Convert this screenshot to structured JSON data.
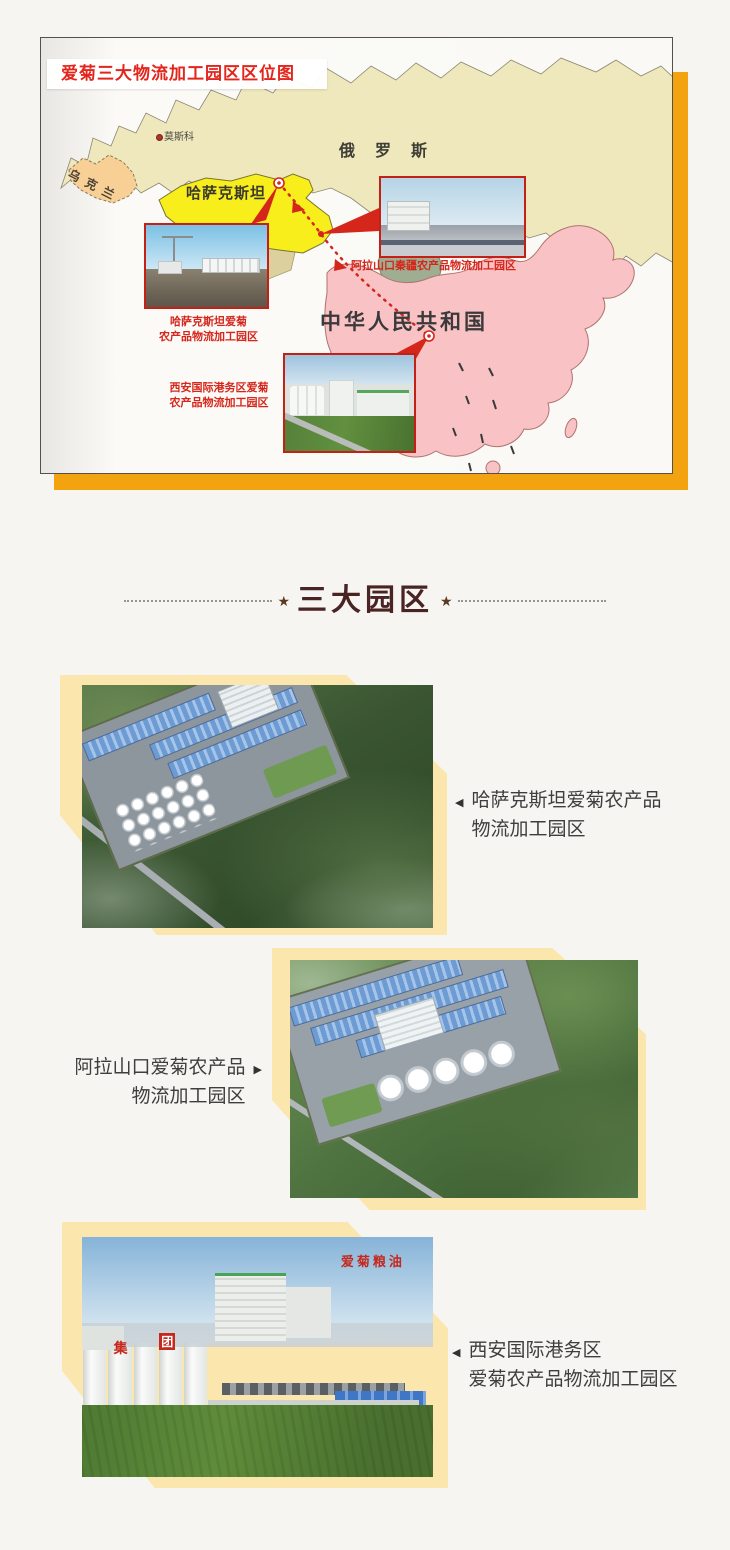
{
  "map": {
    "title": "爱菊三大物流加工园区区位图",
    "labels": {
      "moscow": "莫斯科",
      "russia": "俄罗斯",
      "ukraine": "乌克兰",
      "kazakhstan": "哈萨克斯坦",
      "china": "中华人民共和国"
    },
    "callouts": {
      "kazakhstan_line1": "哈萨克斯坦爱菊",
      "kazakhstan_line2": "农产品物流加工园区",
      "alashankou": "阿拉山口秦疆农产品物流加工园区",
      "xian_line1": "西安国际港务区爱菊",
      "xian_line2": "农产品物流加工园区"
    },
    "colors": {
      "accent_orange": "#F2A30F",
      "russia_fill": "#EFE8BD",
      "kazakhstan_fill": "#F7EE1B",
      "ukraine_fill": "#F8D096",
      "china_fill": "#F9C2C5",
      "mongolia_fill": "#9FAE90",
      "marker_red": "#D5261B",
      "backing_cream": "#FBE7AE"
    }
  },
  "section": {
    "title": "三大园区",
    "star": "★"
  },
  "parks": [
    {
      "arrow": "◀",
      "line1": "哈萨克斯坦爱菊农产品",
      "line2": "物流加工园区"
    },
    {
      "arrow": "▶",
      "line1": "阿拉山口爱菊农产品",
      "line2": "物流加工园区"
    },
    {
      "arrow": "◀",
      "line1": "西安国际港务区",
      "line2": "爱菊农产品物流加工园区",
      "signage": "爱菊粮油",
      "tank_text_1": "集",
      "tank_text_2": "团"
    }
  ]
}
